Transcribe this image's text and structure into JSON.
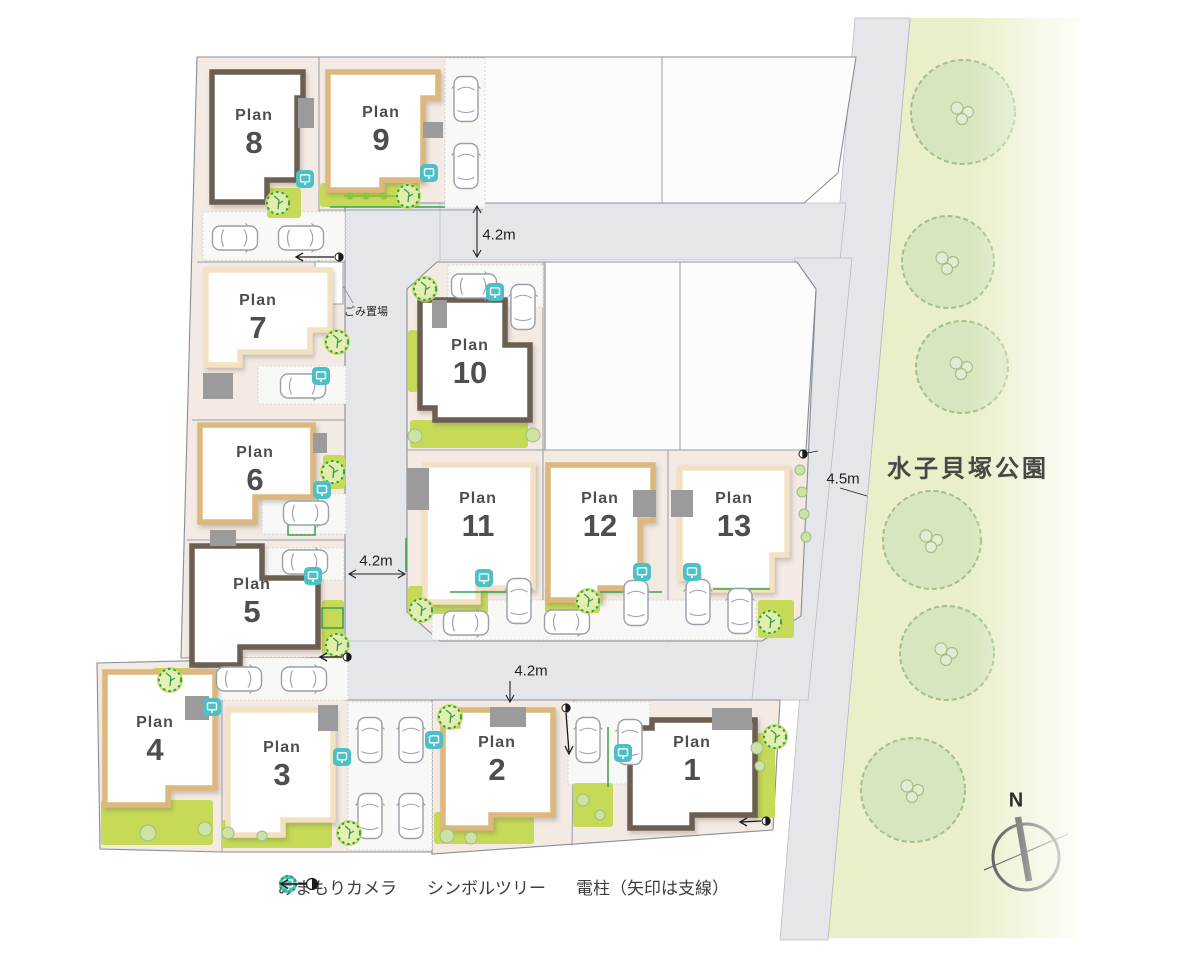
{
  "plans": [
    {
      "label": "Plan",
      "number": "1"
    },
    {
      "label": "Plan",
      "number": "2"
    },
    {
      "label": "Plan",
      "number": "3"
    },
    {
      "label": "Plan",
      "number": "4"
    },
    {
      "label": "Plan",
      "number": "5"
    },
    {
      "label": "Plan",
      "number": "6"
    },
    {
      "label": "Plan",
      "number": "7"
    },
    {
      "label": "Plan",
      "number": "8"
    },
    {
      "label": "Plan",
      "number": "9"
    },
    {
      "label": "Plan",
      "number": "10"
    },
    {
      "label": "Plan",
      "number": "11"
    },
    {
      "label": "Plan",
      "number": "12"
    },
    {
      "label": "Plan",
      "number": "13"
    }
  ],
  "dimensions": {
    "top_road": "4.2m",
    "left_road": "4.2m",
    "bottom_road": "4.2m",
    "park_road": "4.5m"
  },
  "park": {
    "name": "水子貝塚公園"
  },
  "map_labels": {
    "garbage": "ごみ置場",
    "compass_north": "N"
  },
  "legend": [
    {
      "icon": "camera",
      "label": "みまもりカメラ"
    },
    {
      "icon": "symbol-tree",
      "label": "シンボルツリー"
    },
    {
      "icon": "utility-pole",
      "label": "電柱（矢印は支線）"
    }
  ],
  "colors": {
    "road": "#e4e6ea",
    "lot_ground": "#f3eae3",
    "empty_lot": "#fcfcfd",
    "park": "#e9efc9",
    "park_tree_fill": "#d8e6bf",
    "park_tree_stroke": "#a3c086",
    "lawn": "#c6da58",
    "house_brown": "#6c5f52",
    "house_tan": "#dcb87d",
    "house_cream": "#f2e2c2",
    "porch_gray": "#9b9b9b",
    "camera_teal": "#4cc0c7",
    "symbol_tree_green": "#2aa14b",
    "car_outline": "#9aa0a7",
    "label_text": "#4e4e4e"
  }
}
